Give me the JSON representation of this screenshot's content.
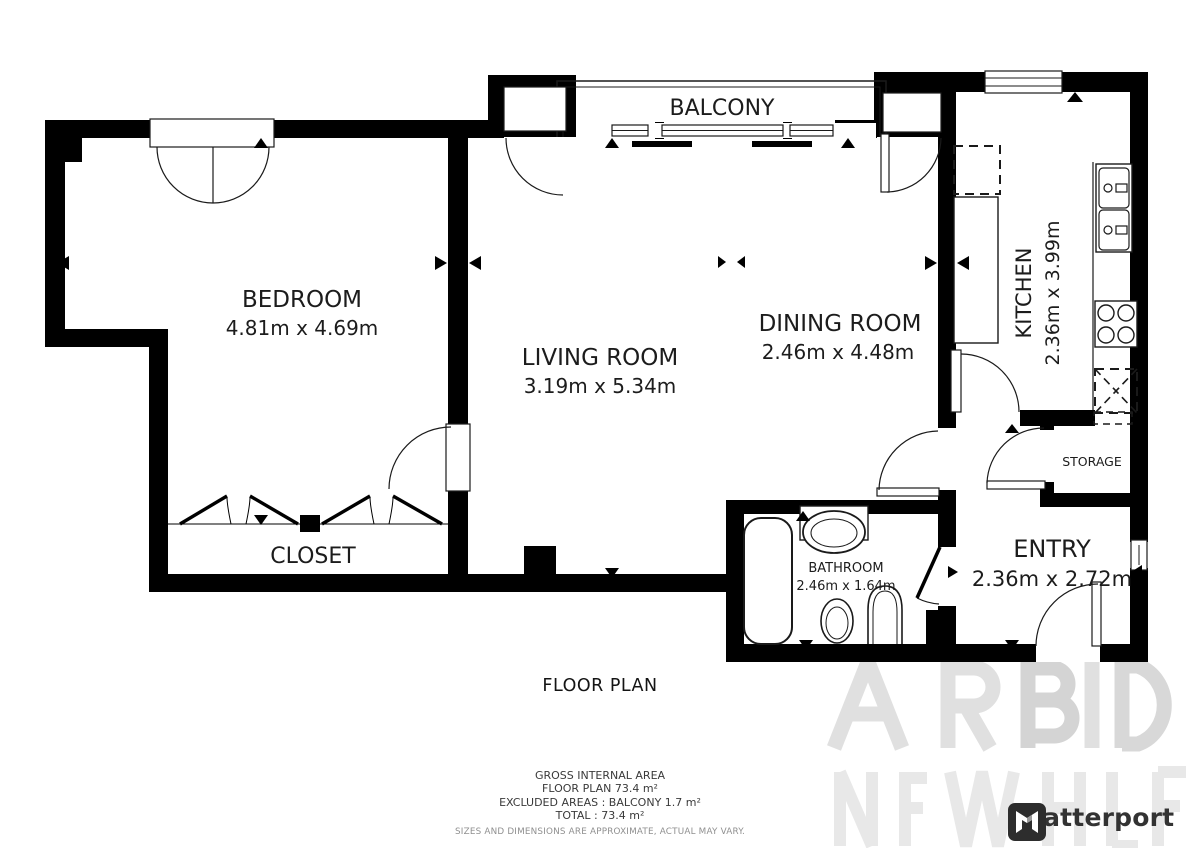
{
  "plan": {
    "title": "FLOOR PLAN",
    "rooms": [
      {
        "name": "BEDROOM",
        "dims": "4.81m x 4.69m"
      },
      {
        "name": "LIVING ROOM",
        "dims": "3.19m x 5.34m"
      },
      {
        "name": "DINING ROOM",
        "dims": "2.46m x 4.48m"
      },
      {
        "name": "KITCHEN",
        "dims": "2.36m x 3.99m"
      },
      {
        "name": "BATHROOM",
        "dims": "2.46m x 1.64m"
      },
      {
        "name": "ENTRY",
        "dims": "2.36m x 2.72m"
      },
      {
        "name": "BALCONY",
        "dims": ""
      },
      {
        "name": "CLOSET",
        "dims": ""
      },
      {
        "name": "STORAGE",
        "dims": ""
      }
    ]
  },
  "summary": {
    "gross_heading": "GROSS INTERNAL AREA",
    "floor_plan_line": "FLOOR PLAN 73.4 m²",
    "excluded_line": "EXCLUDED AREAS :  BALCONY 1.7 m²",
    "total_line": "TOTAL :  73.4 m²",
    "disclaimer": "SIZES AND DIMENSIONS ARE APPROXIMATE, ACTUAL MAY VARY."
  },
  "branding": {
    "logo_text": "Matterport"
  },
  "colors": {
    "wall": "#000000",
    "threshold_gray": "#c4c4c4",
    "label_text": "#1c1c1c",
    "summary_text": "#3a3a3a",
    "disclaimer_text": "#8f8f8f",
    "logo_color": "#333333",
    "watermark": "#dedede"
  }
}
